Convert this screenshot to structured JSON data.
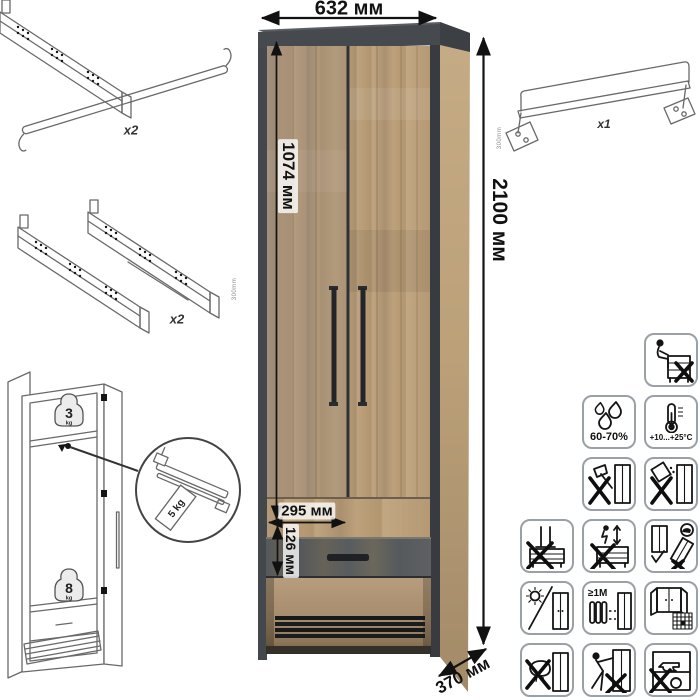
{
  "dimensions": {
    "width": "632 мм",
    "height": "2100 мм",
    "door_height": "1074 мм",
    "drawer_width": "295 мм",
    "drawer_height": "126 мм",
    "depth": "370 мм"
  },
  "hardware": {
    "handle": {
      "qty": "x2"
    },
    "slides": {
      "qty": "x2",
      "length": "300mm"
    },
    "hanger_rail": {
      "qty": "x1",
      "length": "300mm"
    }
  },
  "load_limits": {
    "top_shelf_value": "3",
    "top_shelf_unit": "kg",
    "rail_tag": "5 kg",
    "drawer_value": "8",
    "drawer_unit": "kg"
  },
  "care_icons": [
    {
      "name": "no-sitting-on-furniture",
      "label": ""
    },
    {
      "name": "humidity-range",
      "label": "60-70%"
    },
    {
      "name": "temperature-range",
      "label": "+10...+25°C"
    },
    {
      "name": "no-impact-tools",
      "label": ""
    },
    {
      "name": "no-spilling-liquids",
      "label": ""
    },
    {
      "name": "no-standing-on-furniture",
      "label": ""
    },
    {
      "name": "no-jumping-on-furniture",
      "label": ""
    },
    {
      "name": "transport-upright-only",
      "label": ""
    },
    {
      "name": "avoid-direct-sunlight",
      "label": ""
    },
    {
      "name": "keep-distance-from-heat",
      "label": "≥1M"
    },
    {
      "name": "airing-schedule",
      "label": ""
    },
    {
      "name": "no-abrasive-wet-cleaning",
      "label": ""
    },
    {
      "name": "no-dragging",
      "label": ""
    },
    {
      "name": "no-overloading",
      "label": ""
    }
  ],
  "colors": {
    "background": "#ffffff",
    "wood_light": "#b49a79",
    "wood_mid": "#a58c6e",
    "frame_dark": "#45484d",
    "drawer_front": "#5a5e60",
    "line_art": "#696969",
    "dimension_text": "#111111",
    "icon_border": "#9aa0a5"
  }
}
